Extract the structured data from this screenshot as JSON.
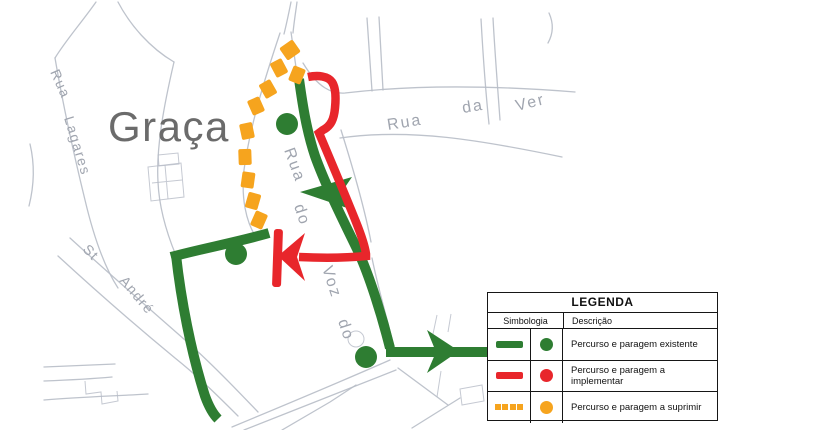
{
  "map": {
    "area_label": "Graça",
    "street_labels": {
      "lagares_rua": "Rua",
      "lagares": "Lagares",
      "ver_rua": "Rua",
      "ver_da": "da",
      "ver_ver": "Ver",
      "voz_rua": "Rua",
      "voz_do": "do",
      "voz_voz": "Voz",
      "voz_do2": "do",
      "andre_st": "St",
      "andre": "André"
    }
  },
  "legend": {
    "title": "LEGENDA",
    "col_symbol": "Simbologia",
    "col_desc": "Descrição",
    "rows": [
      {
        "desc": "Percurso e paragem existente"
      },
      {
        "desc": "Percurso e paragem a implementar"
      },
      {
        "desc": "Percurso e paragem a suprimir"
      }
    ]
  },
  "colors": {
    "existing": "#2e7d32",
    "implement": "#e8262b",
    "suppress": "#f6a41e",
    "street": "#b7bcc7",
    "label_gray": "#a0a5af",
    "area_label": "#6b6b6b"
  }
}
